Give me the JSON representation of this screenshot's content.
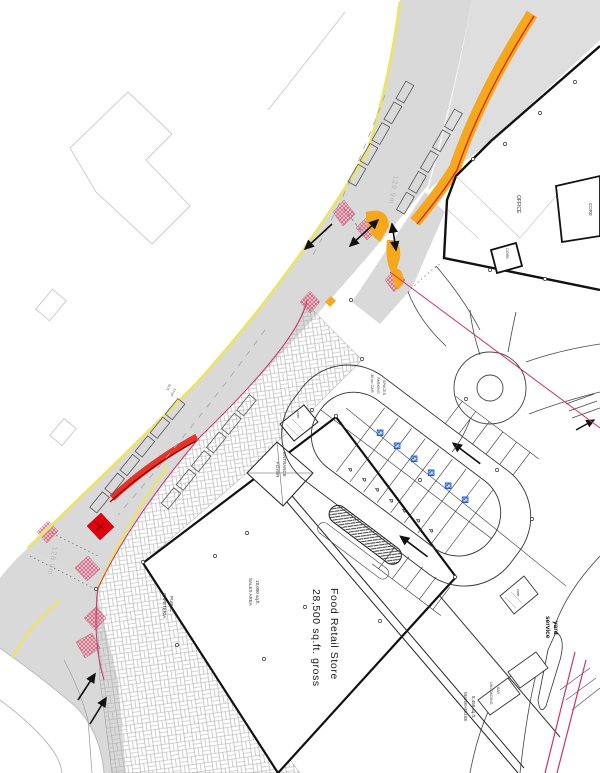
{
  "labels": {
    "store_title": "Food Retail Store",
    "store_area": "28,500 sq.ft. gross",
    "sales_area_1": "SALES AREA",
    "sales_area_2": "18,000 sq.ft.",
    "cafeteria_1": "PUBLIC",
    "cafeteria_2": "CAFETERIA",
    "entrance_1": "ENTRANCE",
    "entrance_2": "FOYER",
    "parking_note_1": "30 no CAR",
    "parking_note_2": "PARKING",
    "parking_note_3": "SPACES",
    "warehouse_1": "WAREHOUSE",
    "warehouse_2": "8,450 sq.ft.",
    "unloading_1": "UNLOADING",
    "unloading_2": "BAY",
    "service_yard_1": "service",
    "service_yard_2": "yard",
    "office": "OFFICE",
    "core_a": "CORE",
    "core_b": "CORE",
    "core_entrance": "core",
    "core_yard": "core",
    "bus_1": "BUS",
    "bus_2": "STOP",
    "dim_upper": "129.9m",
    "dim_lower": "128.9m",
    "p": "P",
    "disabled": "♿"
  },
  "colors": {
    "road_gray": "#d9d9d9",
    "footway_gray": "#dedede",
    "edge_yellow": "#e9e370",
    "band_orange": "#F5A81E",
    "band_red": "#E3342A",
    "marker_red": "#E3000F",
    "crossing_pink": "#E0607E",
    "boundary_red": "#CC3366",
    "paving_line": "#ABABAB"
  }
}
